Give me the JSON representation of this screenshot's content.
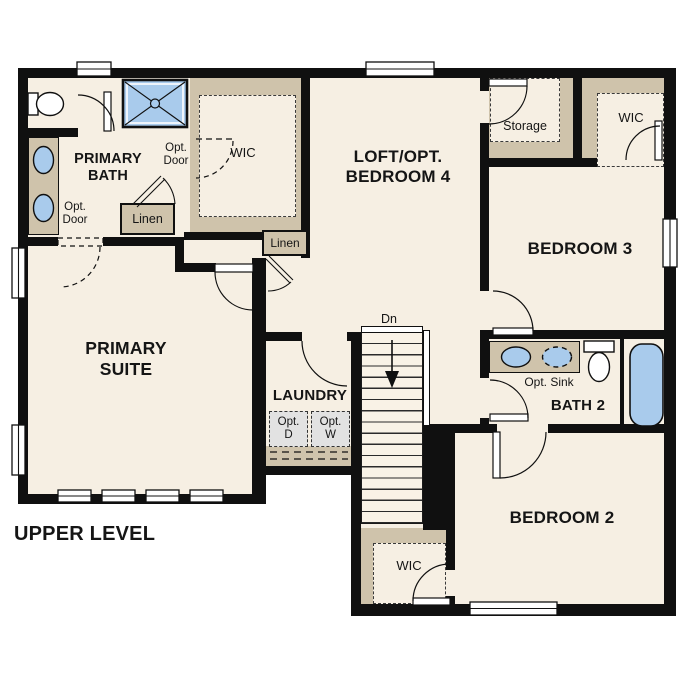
{
  "title": "UPPER LEVEL",
  "colors": {
    "background": "#ffffff",
    "wall": "#101010",
    "floor": "#f6efe3",
    "millwork_tan": "#cfc3ab",
    "fixture_blue": "#a9cbec",
    "appliance_gray": "#e2e2e2"
  },
  "rooms": {
    "primary_suite": "PRIMARY SUITE",
    "primary_bath": "PRIMARY BATH",
    "loft_opt_bedroom4": "LOFT/OPT. BEDROOM 4",
    "bedroom3": "BEDROOM 3",
    "bath2": "BATH 2",
    "bedroom2": "BEDROOM 2",
    "laundry": "LAUNDRY"
  },
  "closets": {
    "primary_wic": "WIC",
    "bedroom3_wic": "WIC",
    "bedroom2_wic": "WIC",
    "storage": "Storage",
    "bath_linen": "Linen",
    "hall_linen": "Linen"
  },
  "annotations": {
    "wic_opt_door": "Opt. Door",
    "bath_opt_door": "Opt. Door",
    "opt_sink": "Opt. Sink",
    "opt_dryer": "Opt. D",
    "opt_washer": "Opt. W",
    "stairs_down": "Dn"
  }
}
